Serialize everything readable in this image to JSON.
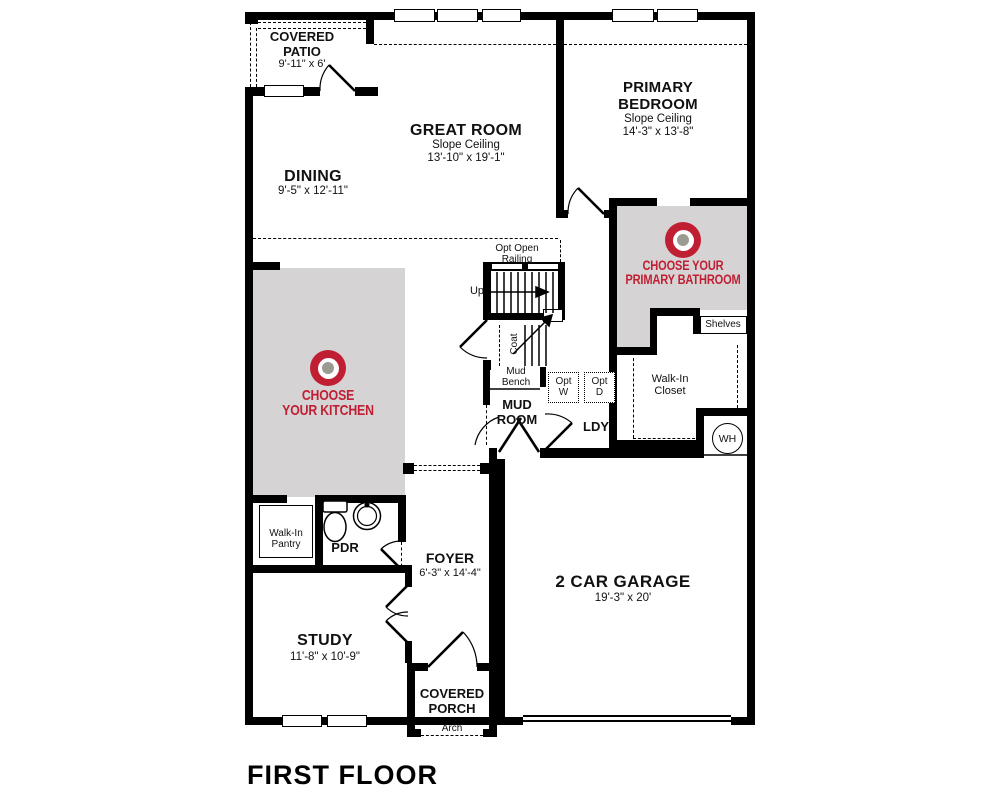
{
  "title": "FIRST FLOOR",
  "colors": {
    "accent_red": "#c01f33",
    "room_fill_gray": "#d6d3d4",
    "target_center_gray": "#9b9b92"
  },
  "rooms": {
    "covered_patio": {
      "name": "COVERED\nPATIO",
      "dims": "9'-11\" x 6'"
    },
    "great_room": {
      "name": "GREAT ROOM",
      "note": "Slope Ceiling",
      "dims": "13'-10\" x 19'-1\""
    },
    "dining": {
      "name": "DINING",
      "dims": "9'-5\" x 12'-11\""
    },
    "primary_bedroom": {
      "name": "PRIMARY\nBEDROOM",
      "note": "Slope Ceiling",
      "dims": "14'-3\" x 13'-8\""
    },
    "study": {
      "name": "STUDY",
      "dims": "11'-8\" x 10'-9\""
    },
    "foyer": {
      "name": "FOYER",
      "dims": "6'-3\" x 14'-4\""
    },
    "garage": {
      "name": "2 CAR GARAGE",
      "dims": "19'-3\" x 20'"
    },
    "covered_porch": {
      "name": "COVERED\nPORCH",
      "note": "Arch"
    },
    "mud_room": {
      "name": "MUD\nROOM"
    },
    "laundry": {
      "name": "LDY"
    },
    "powder": {
      "name": "PDR"
    },
    "pantry": {
      "name": "Walk-In\nPantry"
    },
    "walk_in_closet": {
      "name": "Walk-In\nCloset"
    },
    "shelves": {
      "name": "Shelves"
    },
    "water_heater": {
      "name": "WH"
    }
  },
  "stairs": {
    "railing_note": "Opt Open\nRailing",
    "up": "Up",
    "coat": "Coat"
  },
  "mud_area": {
    "bench": "Mud\nBench",
    "opt_w_line1": "Opt",
    "opt_w_line2": "W",
    "opt_d_line1": "Opt",
    "opt_d_line2": "D"
  },
  "hotspots": {
    "kitchen": {
      "line1": "CHOOSE",
      "line2": "YOUR KITCHEN"
    },
    "bathroom": {
      "line1": "CHOOSE YOUR",
      "line2": "PRIMARY BATHROOM"
    }
  }
}
